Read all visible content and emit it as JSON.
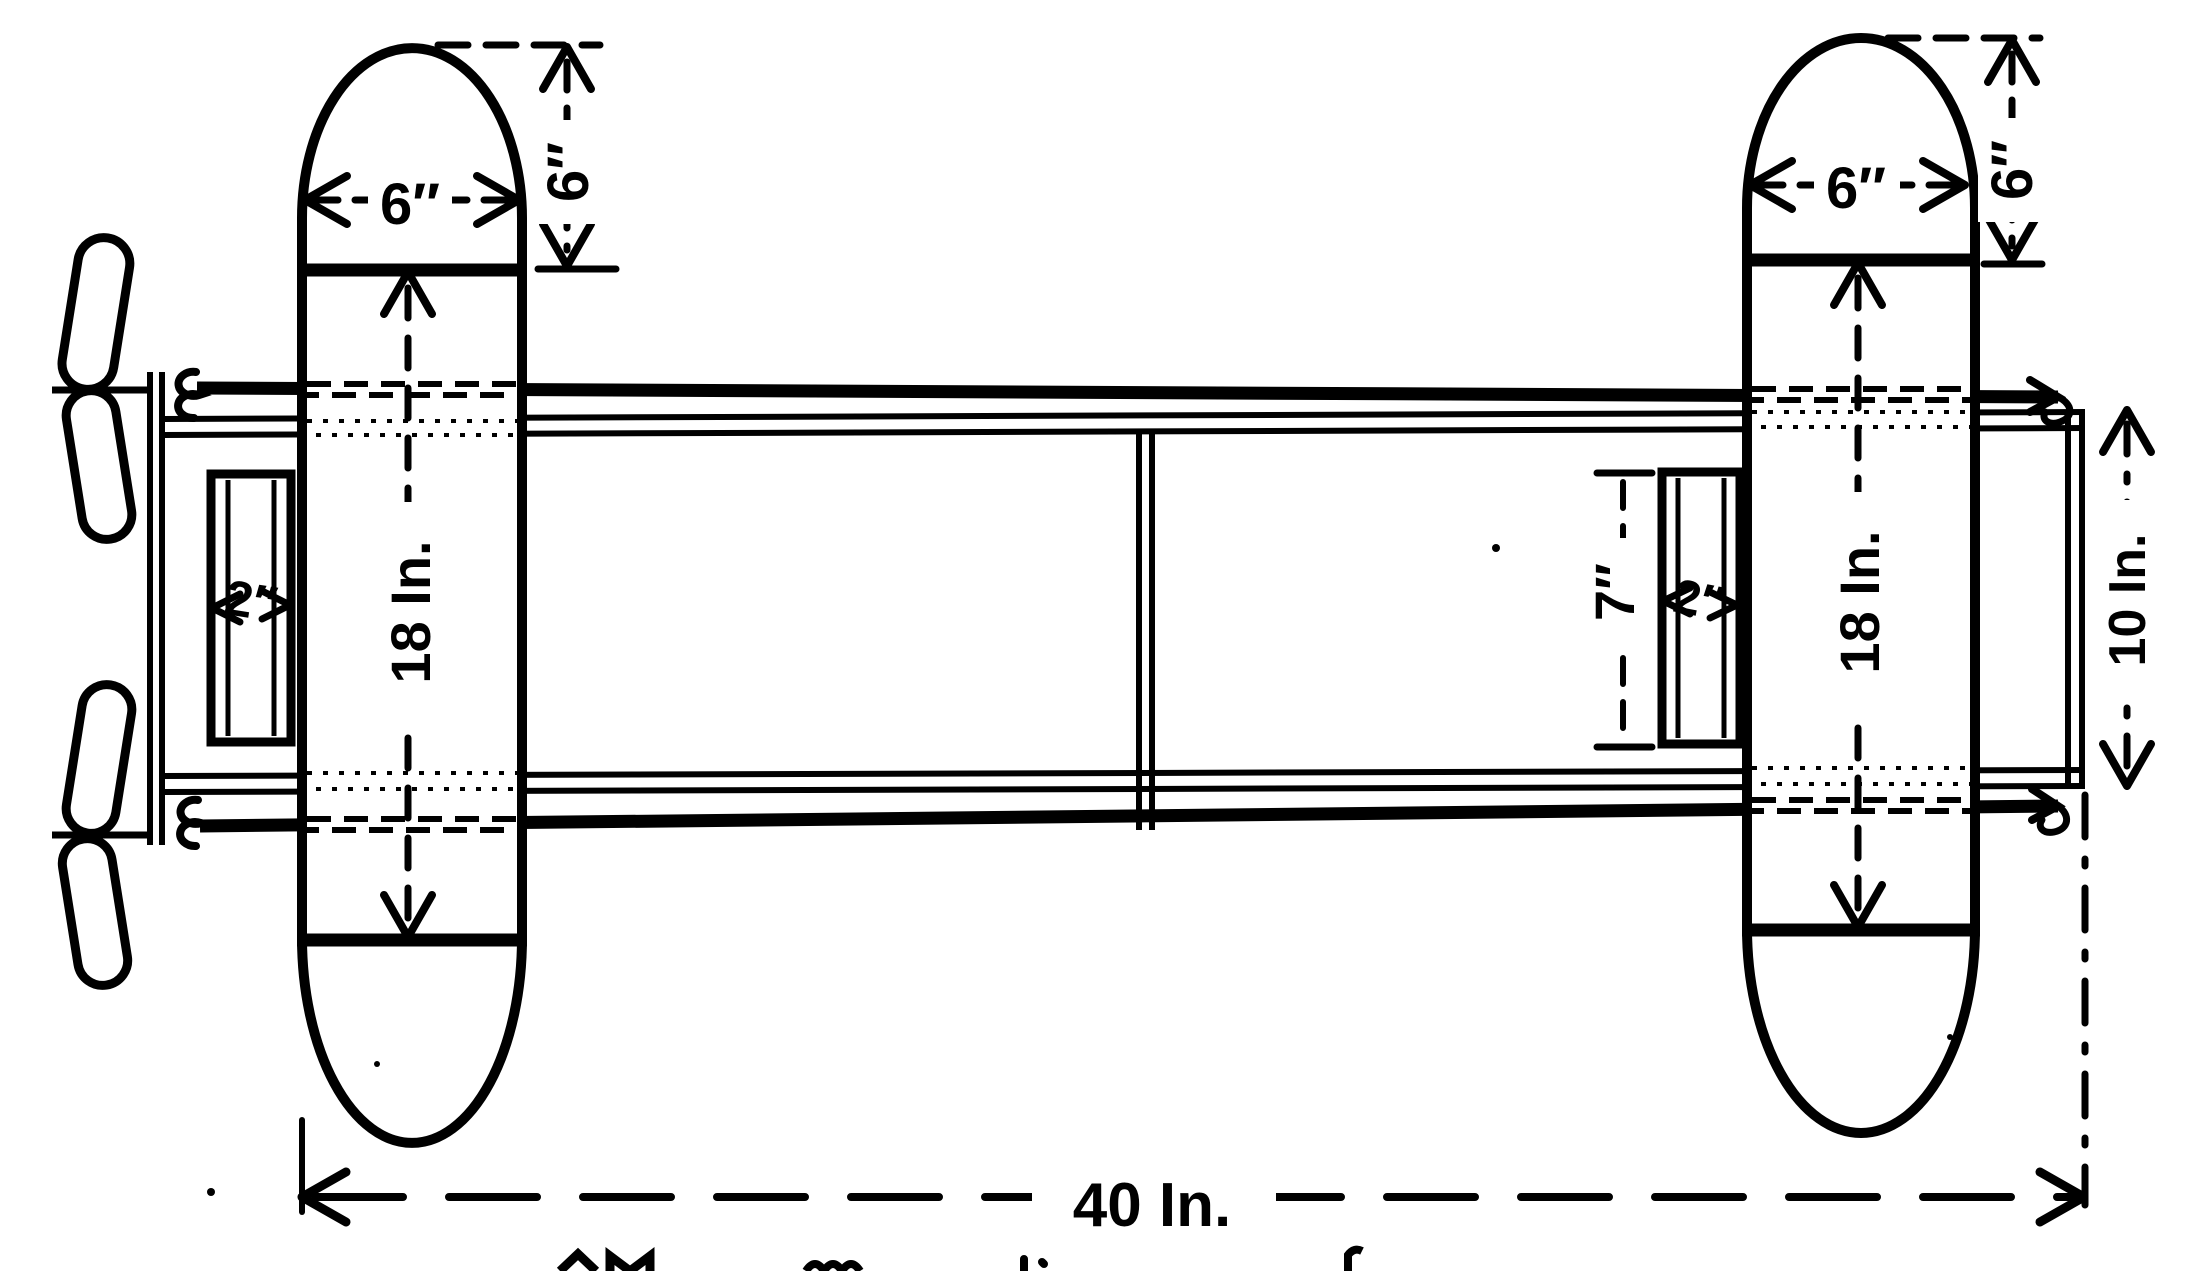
{
  "drawing": {
    "type": "plan-view technical drawing of a twin-float model hydro-aeroplane frame",
    "paper_color": "#ffffff",
    "ink_color": "#000000",
    "labels": {
      "left_float_width": "6″",
      "left_float_nose_depth": "6″",
      "left_float_length": "18 In.",
      "left_motor_bar_width": "2″",
      "right_float_width": "6″",
      "right_float_nose_depth": "6″",
      "right_float_length": "18 In.",
      "right_motor_bar_width": "2″",
      "right_motor_bar_length": "7″",
      "tail_plane_width": "10 In.",
      "overall_length": "40 In."
    }
  }
}
